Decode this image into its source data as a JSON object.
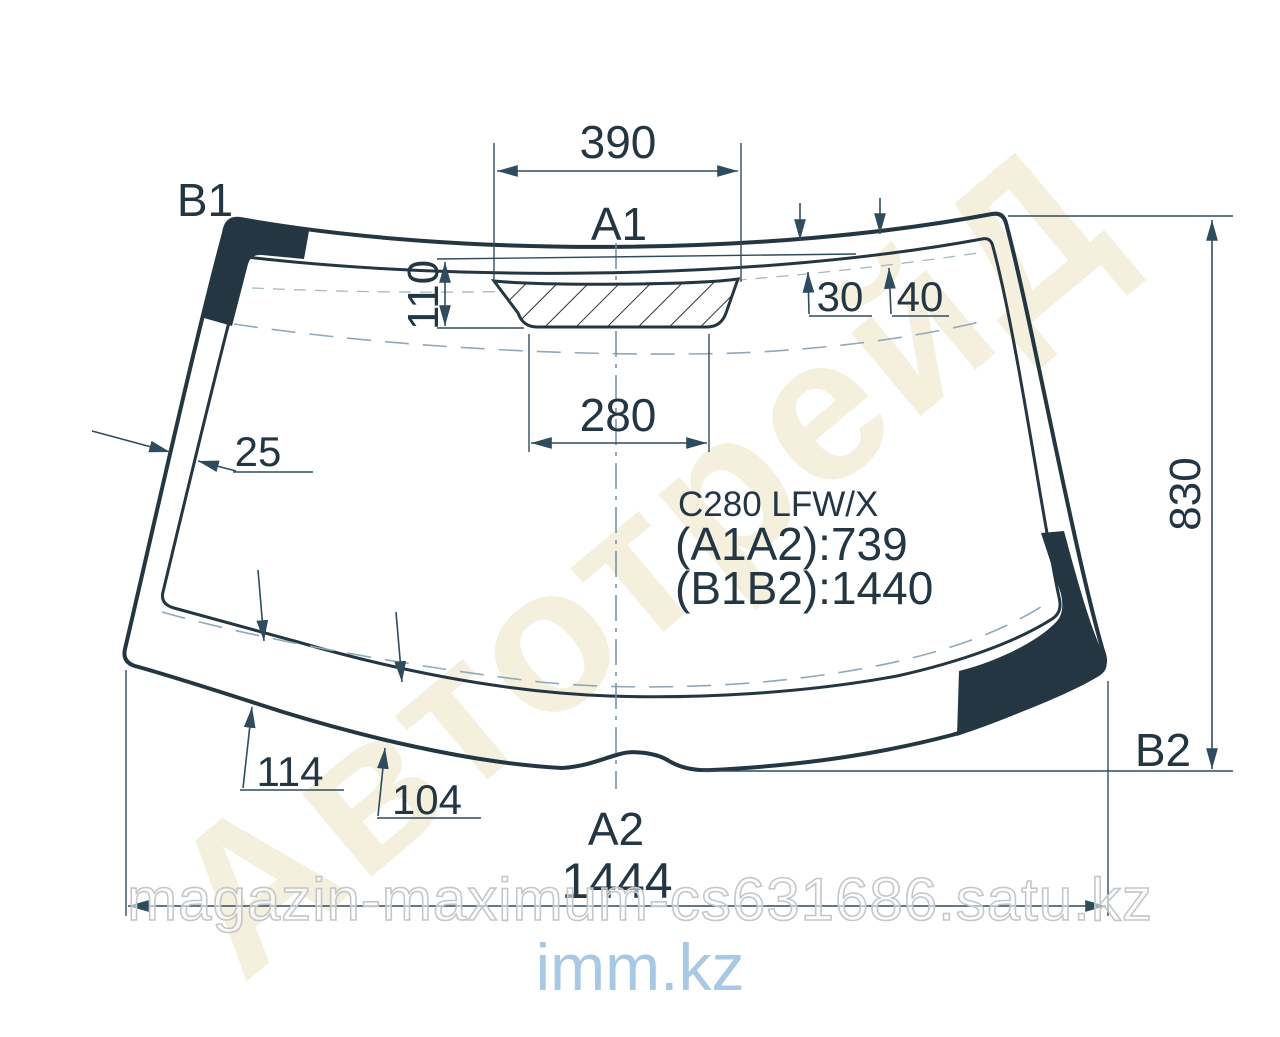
{
  "part": {
    "model": "C280 LFW/X",
    "a1a2": "(A1A2):739",
    "b1b2": "(B1B2):1440"
  },
  "labels": {
    "a1": "A1",
    "a2": "A2",
    "b1": "B1",
    "b2": "B2"
  },
  "dims": {
    "d390": "390",
    "d280": "280",
    "d110": "110",
    "d30": "30",
    "d40": "40",
    "d25": "25",
    "d830": "830",
    "d114": "114",
    "d104": "104",
    "d1444": "1444"
  },
  "watermarks": {
    "diagonal": "АвтотрейД",
    "store": "magazin-maximum-cs631686.satu.kz",
    "site": "imm.kz"
  },
  "colors": {
    "line": "#243642",
    "dim_line": "#2f4c5e",
    "dash": "#8fa9b8",
    "watermark_beige": "#f5f0dd",
    "watermark_blue": "#a9c8e3"
  }
}
